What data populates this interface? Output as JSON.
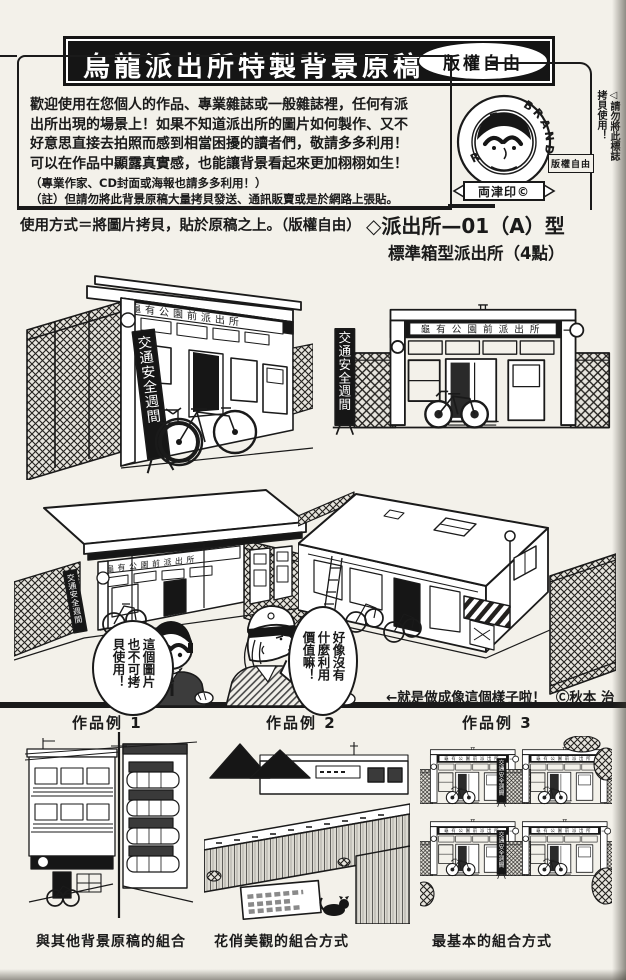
{
  "colors": {
    "ink": "#1a1a1a",
    "paper": "#f3f1ea"
  },
  "header": {
    "title": "烏龍派出所特製背景原稿",
    "badge": "版權自由",
    "intro_lines": [
      "歡迎使用在您個人的作品、專業雜誌或一般雜誌裡，任何有派",
      "出所出現的場景上！如果不知道派出所的圖片如何製作、又不",
      "好意思直接去拍照而感到相當困擾的讀者們，敬請多多利用！",
      "可以在作品中顯露真實感，也能讓背景看起來更加栩栩如生！"
    ],
    "note_lines": [
      "（專業作家、CD封面或海報也請多多利用！）",
      "（註）但請勿將此背景原稿大量拷貝發送、通訊販賣或是於網路上張貼。"
    ],
    "stamp": {
      "arc_left": "RYOTSU",
      "arc_right": "BRAND",
      "ribbon": "両津印©",
      "side_note": "◁請勿將此標誌拷貝使用！",
      "box": "版權自由"
    }
  },
  "instructions": {
    "usage": "使用方式＝將圖片拷貝，貼於原稿之上。（版權自由）",
    "model_title": "◇派出所—01（A）型",
    "model_subtitle": "標準箱型派出所（4點）"
  },
  "art": {
    "sign": "龜有公園前派出所",
    "banner": "交通安全週間"
  },
  "dialogue": {
    "ryotsu": "這個圖片也不可拷貝使用！",
    "nakagawa": "好像沒有什麼利用價值嘛！"
  },
  "caption": {
    "arrow_note": "←就是做成像這個樣子啦！",
    "credit": "Ⓒ秋本 治"
  },
  "examples": [
    {
      "label": "作品例 1",
      "caption": "與其他背景原稿的組合"
    },
    {
      "label": "作品例 2",
      "caption": "花俏美觀的組合方式"
    },
    {
      "label": "作品例 3",
      "caption": "最基本的組合方式"
    }
  ]
}
